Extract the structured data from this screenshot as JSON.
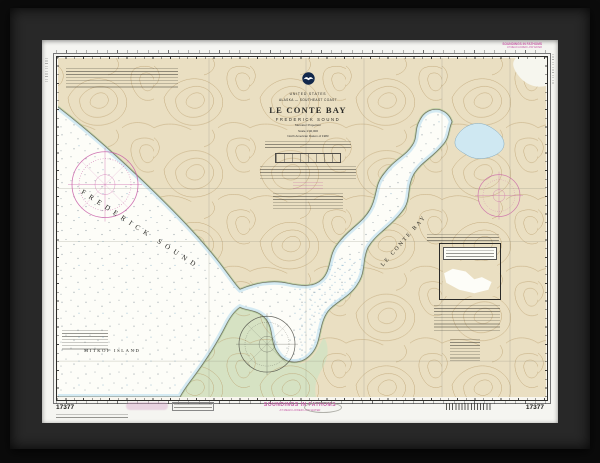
{
  "chart": {
    "number": "17377",
    "title_block": {
      "country": "UNITED STATES",
      "region": "ALASKA — SOUTHEAST COAST",
      "title": "LE CONTE BAY",
      "subtitle": "FREDERICK SOUND",
      "projection": "Mercator Projection",
      "scale": "Scale 1:40,000",
      "datum": "North American Datum of 1983"
    },
    "margin": {
      "soundings_note": "SOUNDINGS IN FATHOMS",
      "soundings_subnote": "AT MEAN LOWER LOW WATER",
      "chart_number_left": "17377",
      "chart_number_right": "17377"
    },
    "place_labels": {
      "sound": "FREDERICK SOUND",
      "bay": "LE CONTE BAY",
      "island": "MITKOF ISLAND"
    }
  },
  "colors": {
    "land": "#eadfc2",
    "water": "#fdfdf8",
    "shallow": "#cfe8f2",
    "flats": "#d6e2c3",
    "contour": "#b79a68",
    "magenta": "#c75aa6",
    "graticule": "#8d8d7e",
    "ink": "#2b2b28",
    "frame": "#282828",
    "mat": "#f5f5f1",
    "paper": "#f8f6ef"
  }
}
